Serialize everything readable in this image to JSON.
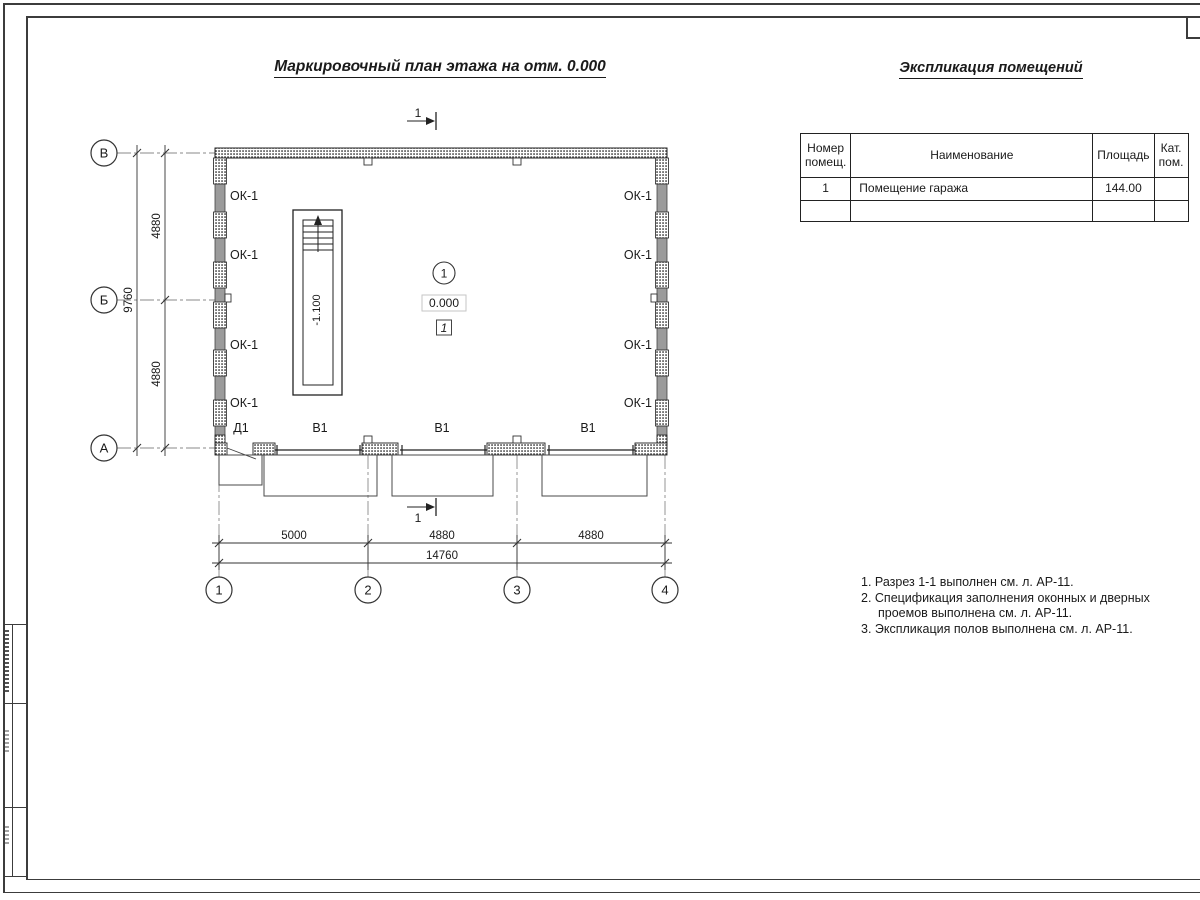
{
  "colors": {
    "line": "#222222",
    "wall_gray": "#9b9b9b",
    "frame": "#3c3c3c"
  },
  "plan": {
    "title": "Маркировочный план этажа на отм. 0.000",
    "section_mark": "1",
    "axes_rows": [
      "В",
      "Б",
      "А"
    ],
    "axes_cols": [
      "1",
      "2",
      "3",
      "4"
    ],
    "dim_left_seg1": "4880",
    "dim_left_seg2": "4880",
    "dim_left_total": "9760",
    "dim_bottom_seg1": "5000",
    "dim_bottom_seg2": "4880",
    "dim_bottom_seg3": "4880",
    "dim_bottom_total": "14760",
    "window_label": "ОК-1",
    "gate_label": "В1",
    "door_label": "Д1",
    "room_number": "1",
    "room_level": "0.000",
    "floor_type_mark": "1",
    "stair_level": "-1.100"
  },
  "table": {
    "title": "Экспликация помещений",
    "col_num": "Номер помещ.",
    "col_name": "Наименование",
    "col_area": "Площадь",
    "col_cat": "Кат. пом.",
    "rows": [
      {
        "num": "1",
        "name": "Помещение гаража",
        "area": "144.00",
        "cat": ""
      },
      {
        "num": "",
        "name": "",
        "area": "",
        "cat": ""
      }
    ]
  },
  "notes": {
    "line1": "1. Разрез 1-1 выполнен см. л. АР-11.",
    "line2": "2. Спецификация заполнения оконных и дверных",
    "line3": "проемов выполнена см. л. АР-11.",
    "line4": "3. Экспликация полов выполнена см. л. АР-11."
  }
}
